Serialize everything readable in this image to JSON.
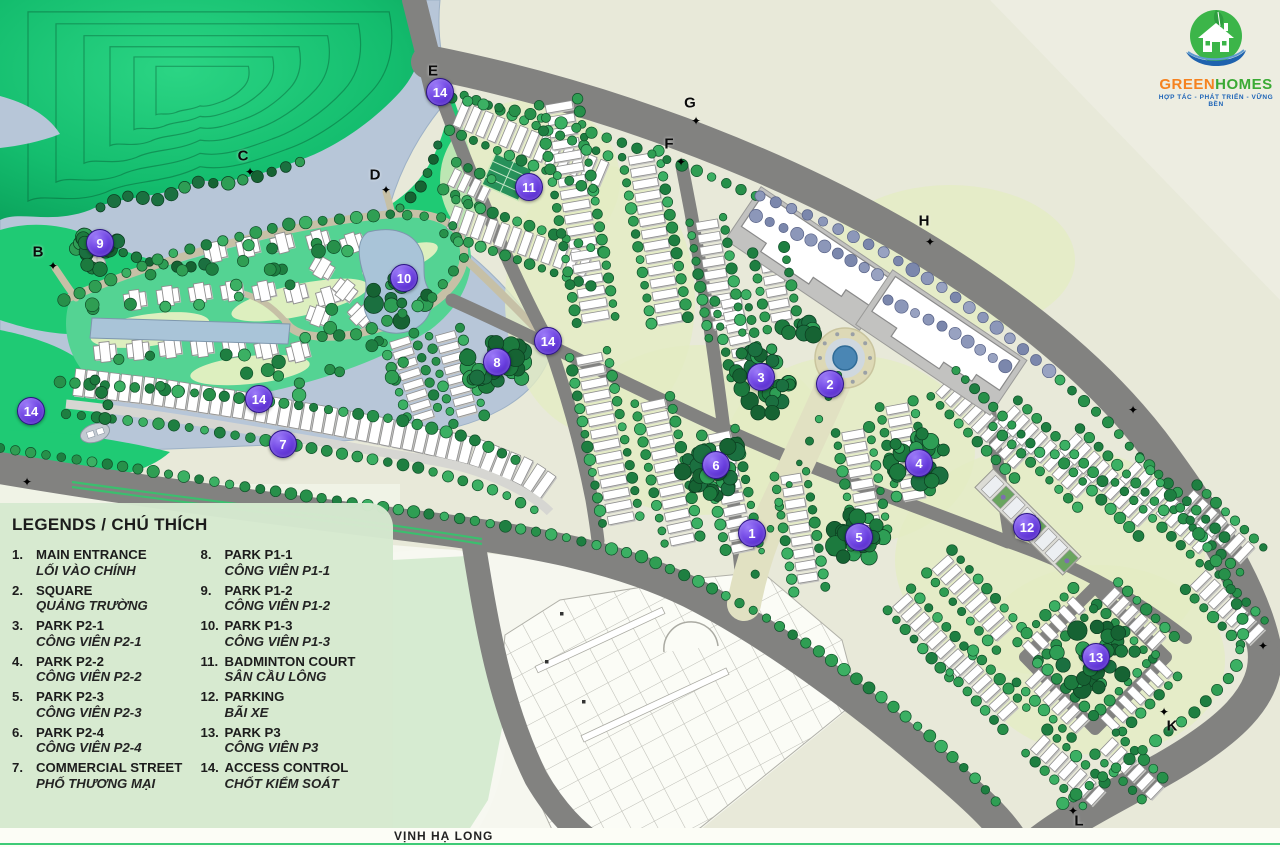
{
  "logo": {
    "brand_green": "GREEN",
    "brand_homes": "HOMES",
    "tagline": "HỢP TÁC - PHÁT TRIỂN - VỮNG BỀN"
  },
  "legend": {
    "title": "LEGENDS / CHÚ THÍCH",
    "items": [
      {
        "num": "1.",
        "en": "MAIN ENTRANCE",
        "vi": "LỐI VÀO CHÍNH"
      },
      {
        "num": "2.",
        "en": "SQUARE",
        "vi": "QUẢNG TRƯỜNG"
      },
      {
        "num": "3.",
        "en": "PARK P2-1",
        "vi": "CÔNG VIÊN P2-1"
      },
      {
        "num": "4.",
        "en": "PARK P2-2",
        "vi": "CÔNG VIÊN P2-2"
      },
      {
        "num": "5.",
        "en": "PARK P2-3",
        "vi": "CÔNG VIÊN P2-3"
      },
      {
        "num": "6.",
        "en": "PARK P2-4",
        "vi": "CÔNG VIÊN P2-4"
      },
      {
        "num": "7.",
        "en": "COMMERCIAL STREET",
        "vi": "PHỐ THƯƠNG MẠI"
      },
      {
        "num": "8.",
        "en": "PARK P1-1",
        "vi": "CÔNG VIÊN P1-1"
      },
      {
        "num": "9.",
        "en": "PARK P1-2",
        "vi": "CÔNG VIÊN P1-2"
      },
      {
        "num": "10.",
        "en": "PARK P1-3",
        "vi": "CÔNG VIÊN P1-3"
      },
      {
        "num": "11.",
        "en": "BADMINTON COURT",
        "vi": "SÂN CẦU LÔNG"
      },
      {
        "num": "12.",
        "en": "PARKING",
        "vi": "BÃI XE"
      },
      {
        "num": "13.",
        "en": "PARK P3",
        "vi": "CÔNG VIÊN P3"
      },
      {
        "num": "14.",
        "en": "ACCESS CONTROL",
        "vi": "CHỐT KIỂM SOÁT"
      }
    ]
  },
  "map": {
    "bay_label": "VỊNH HẠ LONG",
    "markers": [
      {
        "label": "14",
        "x": 440,
        "y": 92
      },
      {
        "label": "11",
        "x": 529,
        "y": 187
      },
      {
        "label": "9",
        "x": 100,
        "y": 243
      },
      {
        "label": "10",
        "x": 404,
        "y": 278
      },
      {
        "label": "14",
        "x": 548,
        "y": 341
      },
      {
        "label": "8",
        "x": 497,
        "y": 362
      },
      {
        "label": "3",
        "x": 761,
        "y": 377
      },
      {
        "label": "2",
        "x": 830,
        "y": 384
      },
      {
        "label": "14",
        "x": 259,
        "y": 399
      },
      {
        "label": "14",
        "x": 31,
        "y": 411
      },
      {
        "label": "7",
        "x": 283,
        "y": 444
      },
      {
        "label": "6",
        "x": 716,
        "y": 465
      },
      {
        "label": "4",
        "x": 919,
        "y": 463
      },
      {
        "label": "1",
        "x": 752,
        "y": 533
      },
      {
        "label": "5",
        "x": 859,
        "y": 537
      },
      {
        "label": "12",
        "x": 1027,
        "y": 527
      },
      {
        "label": "13",
        "x": 1096,
        "y": 657
      }
    ],
    "gates": [
      {
        "label": "B",
        "x": 38,
        "y": 252,
        "cx": 53,
        "cy": 266
      },
      {
        "label": "C",
        "x": 243,
        "y": 156,
        "cx": 250,
        "cy": 172
      },
      {
        "label": "D",
        "x": 375,
        "y": 175,
        "cx": 386,
        "cy": 190
      },
      {
        "label": "E",
        "x": 433,
        "y": 71,
        "cx": 440,
        "cy": 84
      },
      {
        "label": "F",
        "x": 669,
        "y": 144,
        "cx": 681,
        "cy": 162
      },
      {
        "label": "G",
        "x": 690,
        "y": 103,
        "cx": 696,
        "cy": 121
      },
      {
        "label": "H",
        "x": 924,
        "y": 221,
        "cx": 930,
        "cy": 242
      },
      {
        "label": "K",
        "x": 1172,
        "y": 726,
        "cx": 1164,
        "cy": 712
      },
      {
        "label": "L",
        "x": 1079,
        "y": 821,
        "cx": 1073,
        "cy": 811
      }
    ],
    "crosses": [
      {
        "x": 1133,
        "y": 410
      },
      {
        "x": 1263,
        "y": 646
      },
      {
        "x": 27,
        "y": 482
      }
    ]
  },
  "colors": {
    "background": "#e8e9d9",
    "water": "#b7c6d8",
    "hill_green": "#16c878",
    "road_gray": "#828280",
    "marker_purple": "#6a3df0",
    "legend_bg": "#d6e9d0",
    "bay_line_green": "#3ecb77"
  }
}
